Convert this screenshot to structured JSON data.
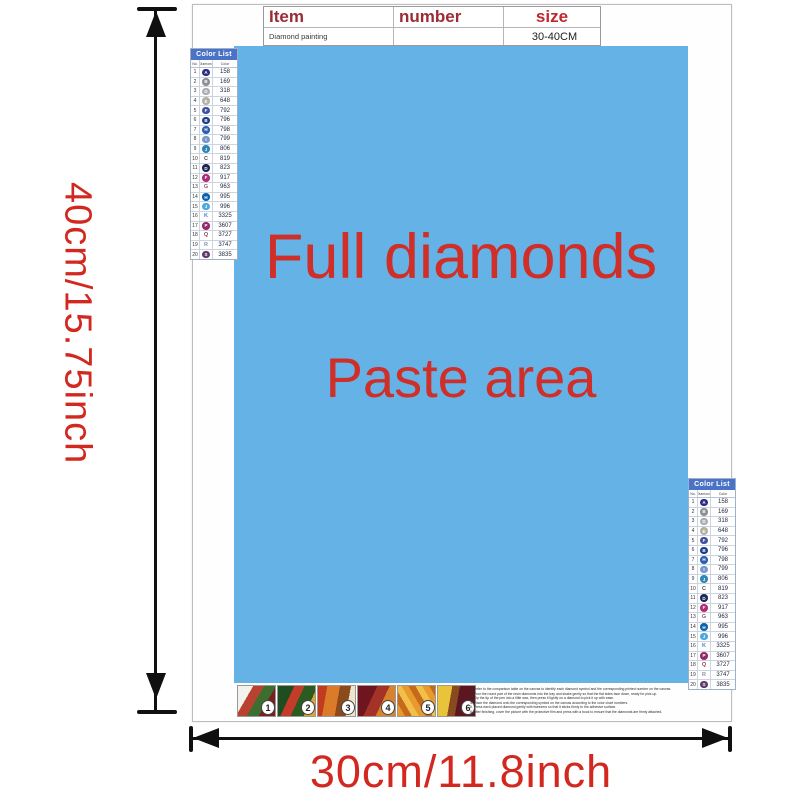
{
  "dimensions": {
    "height_label": "40cm/15.75inch",
    "width_label": "30cm/11.8inch",
    "label_color": "#d2281f",
    "arrow_color": "#101010"
  },
  "page": {
    "item_table": {
      "headers": [
        "Item",
        "number",
        "size"
      ],
      "row": {
        "item": "Diamond painting",
        "number": "",
        "size": "30-40CM"
      }
    },
    "paste_area": {
      "line1": "Full diamonds",
      "line2": "Paste area",
      "bg_color": "#65b3e6",
      "text_color": "#cf2f28"
    },
    "color_list": {
      "title": "Color List",
      "columns": [
        "No.",
        "Diamond",
        "Color"
      ],
      "header_bg": "#4a73c8",
      "rows": [
        {
          "no": "1",
          "sym": "A",
          "code": "158",
          "circle": "#2b2e83",
          "sym_color": "#ffffff"
        },
        {
          "no": "2",
          "sym": "B",
          "code": "169",
          "circle": "#8b8e93",
          "sym_color": "#ffffff"
        },
        {
          "no": "3",
          "sym": "D",
          "code": "318",
          "circle": "#a8abb0",
          "sym_color": "#ffffff"
        },
        {
          "no": "4",
          "sym": "E",
          "code": "648",
          "circle": "#b3b0a4",
          "sym_color": "#ffffff"
        },
        {
          "no": "5",
          "sym": "F",
          "code": "792",
          "circle": "#41519e",
          "sym_color": "#ffffff"
        },
        {
          "no": "6",
          "sym": "B",
          "code": "796",
          "circle": "#1c3c8c",
          "sym_color": "#ffffff"
        },
        {
          "no": "7",
          "sym": "H",
          "code": "798",
          "circle": "#2b5cb4",
          "sym_color": "#ffffff"
        },
        {
          "no": "8",
          "sym": "I",
          "code": "799",
          "circle": "#7795cd",
          "sym_color": "#ffffff"
        },
        {
          "no": "9",
          "sym": "J",
          "code": "806",
          "circle": "#2f86b8",
          "sym_color": "#ffffff"
        },
        {
          "no": "10",
          "sym": "C",
          "code": "819",
          "circle": null,
          "sym_color": "#5a4a4a"
        },
        {
          "no": "11",
          "sym": "D",
          "code": "823",
          "circle": "#1b2757",
          "sym_color": "#ffffff"
        },
        {
          "no": "12",
          "sym": "F",
          "code": "917",
          "circle": "#b02a74",
          "sym_color": "#ffffff"
        },
        {
          "no": "13",
          "sym": "G",
          "code": "963",
          "circle": null,
          "sym_color": "#8a5a62"
        },
        {
          "no": "14",
          "sym": "H",
          "code": "995",
          "circle": "#0b63ad",
          "sym_color": "#ffffff"
        },
        {
          "no": "15",
          "sym": "J",
          "code": "996",
          "circle": "#49a8de",
          "sym_color": "#ffffff"
        },
        {
          "no": "16",
          "sym": "K",
          "code": "3325",
          "circle": null,
          "sym_color": "#4a7ec0"
        },
        {
          "no": "17",
          "sym": "P",
          "code": "3607",
          "circle": "#93286b",
          "sym_color": "#ffffff"
        },
        {
          "no": "18",
          "sym": "Q",
          "code": "3727",
          "circle": null,
          "sym_color": "#94424e"
        },
        {
          "no": "19",
          "sym": "R",
          "code": "3747",
          "circle": null,
          "sym_color": "#8c8fae"
        },
        {
          "no": "20",
          "sym": "S",
          "code": "3835",
          "circle": "#5f3a68",
          "sym_color": "#ffffff"
        }
      ]
    },
    "steps": {
      "labels": [
        "1",
        "2",
        "3",
        "4",
        "5",
        "6"
      ]
    },
    "instructions": {
      "lines": [
        "1. Refer to the comparison table on the canvas to identify each diamond symbol and the corresponding printed number on the canvas.",
        "2. Pour the round part of the resin diamonds into the tray and shake gently so that the flat sides face down, ready for pick-up.",
        "3. Dip the tip of the pen into a little wax, then press it lightly on a diamond to pick it up with ease.",
        "4. Place the diamond onto the corresponding symbol on the canvas according to the color chart numbers.",
        "5. Press each placed diamond gently with tweezers so that it sticks firmly to the adhesive surface.",
        "6. After finishing, cover the picture with the protective film and press with a book to ensure that the diamonds are firmly attached."
      ]
    }
  }
}
